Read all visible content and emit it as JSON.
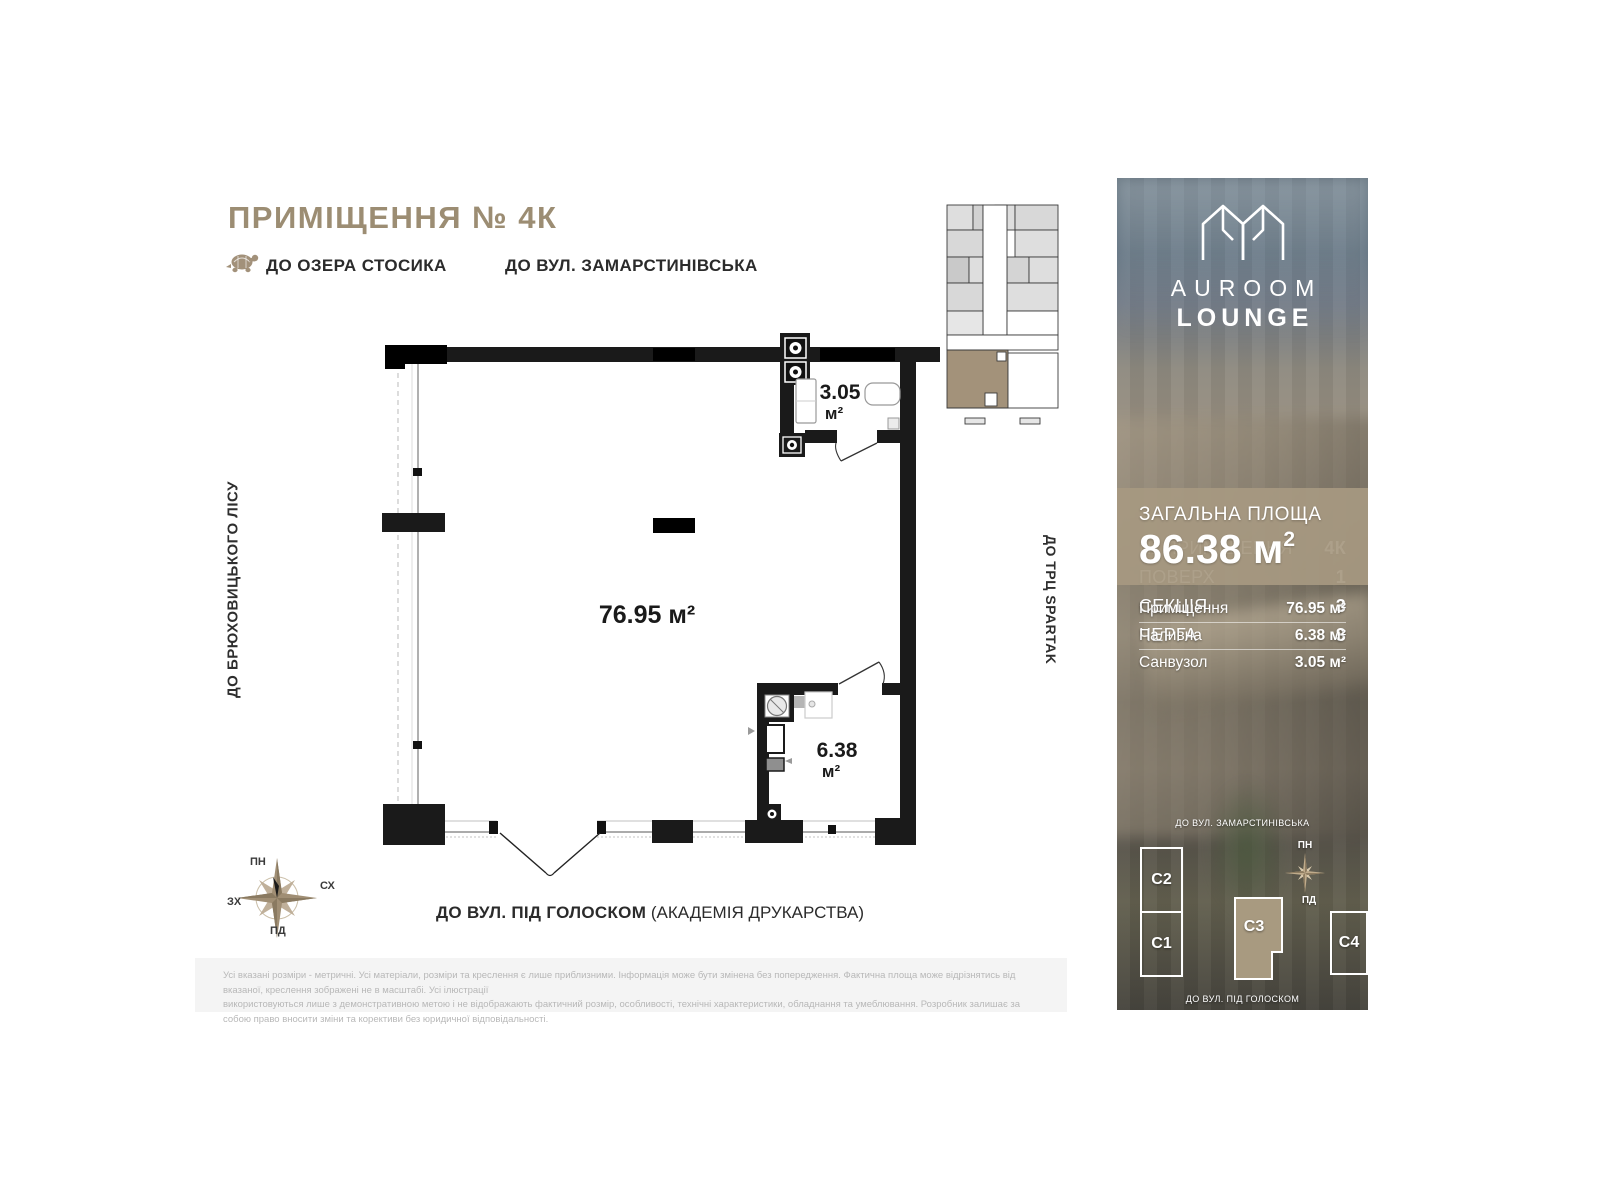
{
  "page": {
    "title": "ПРИМІЩЕННЯ № 4К",
    "directions": {
      "top_left": "ДО ОЗЕРА СТОСИКА",
      "top_right": "ДО ВУЛ. ЗАМАРСТИНІВСЬКА",
      "left_vertical": "ДО БРЮХОВИЦЬКОГО ЛІСУ",
      "right_vertical": "ДО ТРЦ SPARTAK",
      "bottom_bold": "ДО ВУЛ. ПІД ГОЛОСКОМ",
      "bottom_regular": " (АКАДЕМІЯ ДРУКАРСТВА)"
    },
    "compass": {
      "north": "ПН",
      "east": "СХ",
      "south": "ПД",
      "west": "ЗХ"
    },
    "plan_areas": {
      "main": {
        "value": "76.95 м²"
      },
      "bathroom": {
        "value": "3.05",
        "unit": "м²"
      },
      "boiler": {
        "value": "6.38",
        "unit": "м²"
      }
    },
    "disclaimer_line1": "Усі вказані розміри - метричні. Усі матеріали, розміри та креслення є лише приблизними. Інформація може бути змінена без попередження. Фактична площа може відрізнятись від вказаної, креслення зображені не в масштабі. Усі ілюстрації",
    "disclaimer_line2": "використовуються лише з демонстративною метою і не відображають фактичний розмір, особливості, технічні характеристики, обладнання та умеблювання. Розробник залишає за собою право вносити зміни та корективи без юридичної відповідальності."
  },
  "sidebar": {
    "brand": {
      "line1": "AUROOM",
      "line2": "LOUNGE"
    },
    "info_rows": [
      {
        "label": "№ ПРИМІЩЕННЯ",
        "value": "4К"
      },
      {
        "label": "ПОВЕРХ",
        "value": "1"
      },
      {
        "label": "СЕКЦІЯ",
        "value": "3"
      },
      {
        "label": "ЧЕРГА",
        "value": "3"
      }
    ],
    "total": {
      "label": "ЗАГАЛЬНА ПЛОЩА",
      "value": "86.38",
      "unit_base": " м",
      "unit_sup": "2"
    },
    "rooms": [
      {
        "label": "Приміщення",
        "value": "76.95 м²"
      },
      {
        "label": "Паливна",
        "value": "6.38 м²"
      },
      {
        "label": "Санвузол",
        "value": "3.05 м²"
      }
    ],
    "site_map": {
      "street_top": "ДО ВУЛ. ЗАМАРСТИНІВСЬКА",
      "street_bottom": "ДО ВУЛ. ПІД ГОЛОСКОМ",
      "compass_north": "ПН",
      "compass_south": "ПД",
      "buildings": [
        {
          "id": "C2"
        },
        {
          "id": "C1"
        },
        {
          "id": "C3"
        },
        {
          "id": "C4"
        }
      ]
    }
  },
  "colors": {
    "accent": "#9c8d73",
    "highlight_tan": "#a3927a",
    "panel_tan": "#a79981"
  }
}
